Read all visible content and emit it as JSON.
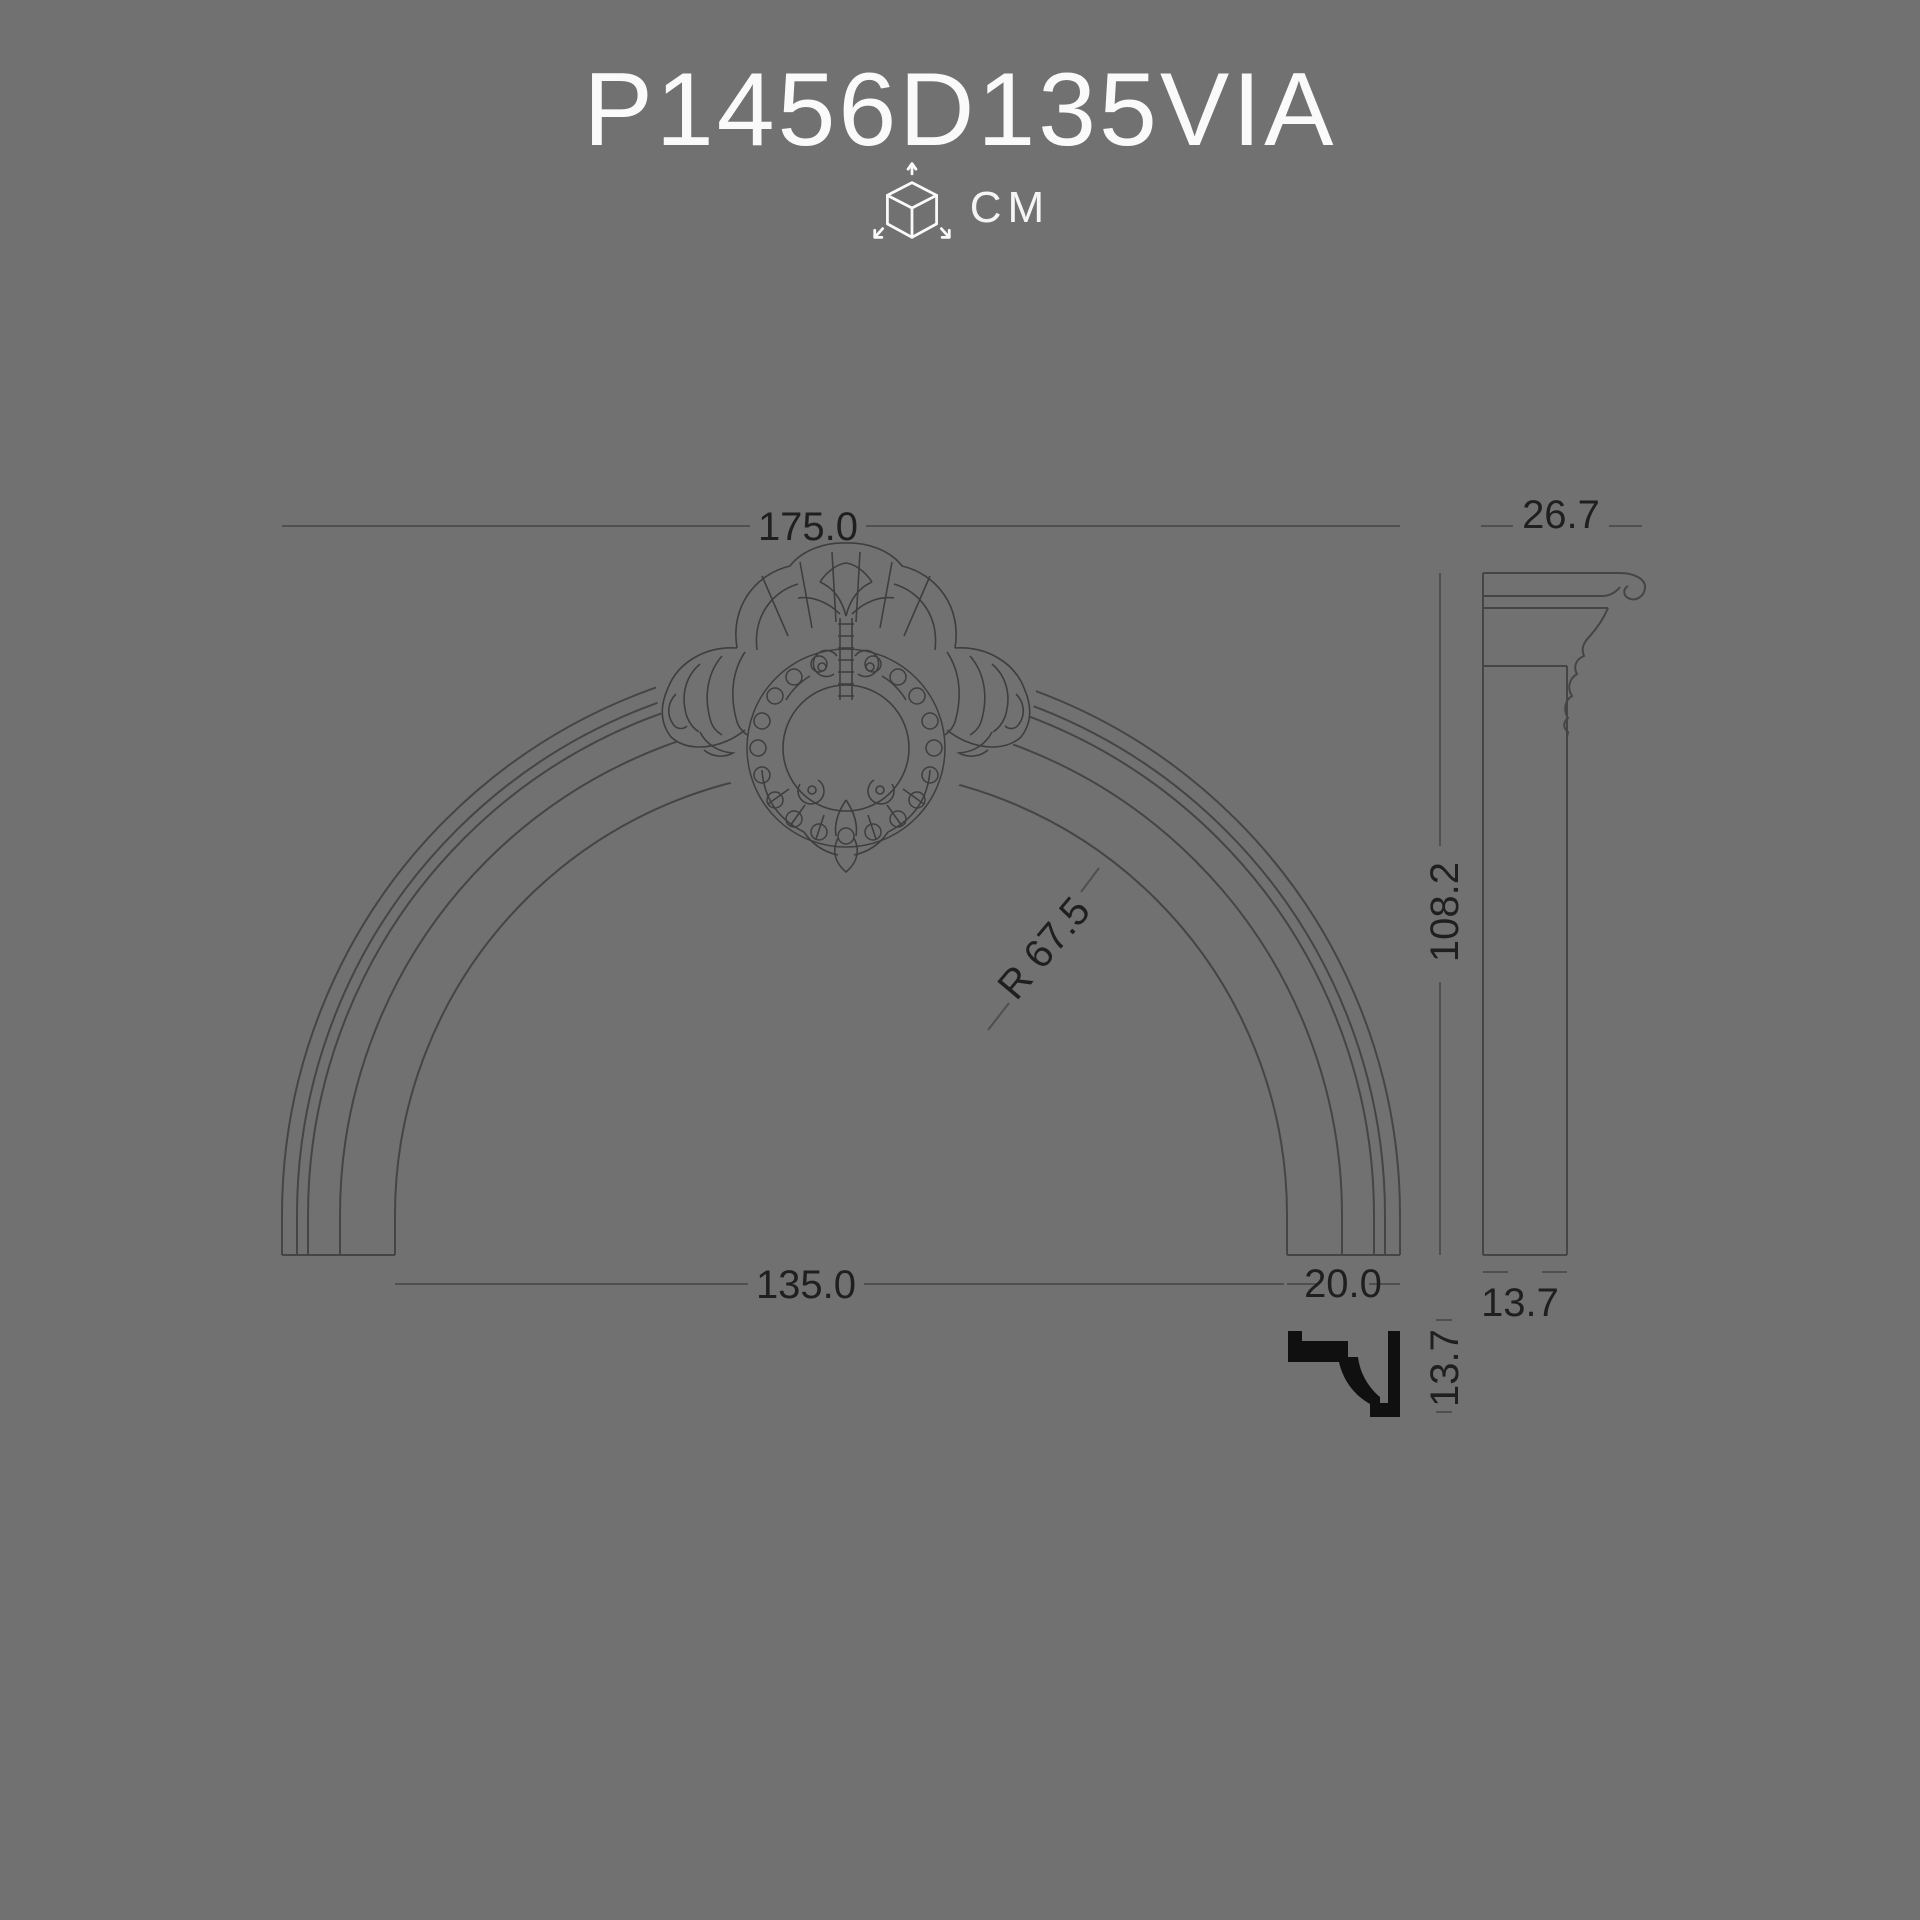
{
  "title": "P1456D135VIA",
  "units": {
    "label": "CM",
    "icon": "dimensions-cube-icon"
  },
  "colors": {
    "background": "#717171",
    "line": "#454545",
    "dimension_text": "#1f1f1f",
    "title_text": "#fafafa",
    "section_fill": "#101010"
  },
  "front_view": {
    "description": "arched pediment with baroque cartouche keystone",
    "dimensions": {
      "overall_width": "175.0",
      "inner_width": "135.0",
      "band_width": "20.0",
      "radius": "R 67.5"
    }
  },
  "side_view": {
    "dimensions": {
      "depth": "26.7",
      "height": "108.2",
      "bottom_depth": "13.7"
    }
  },
  "section_profile": {
    "height": "13.7"
  }
}
